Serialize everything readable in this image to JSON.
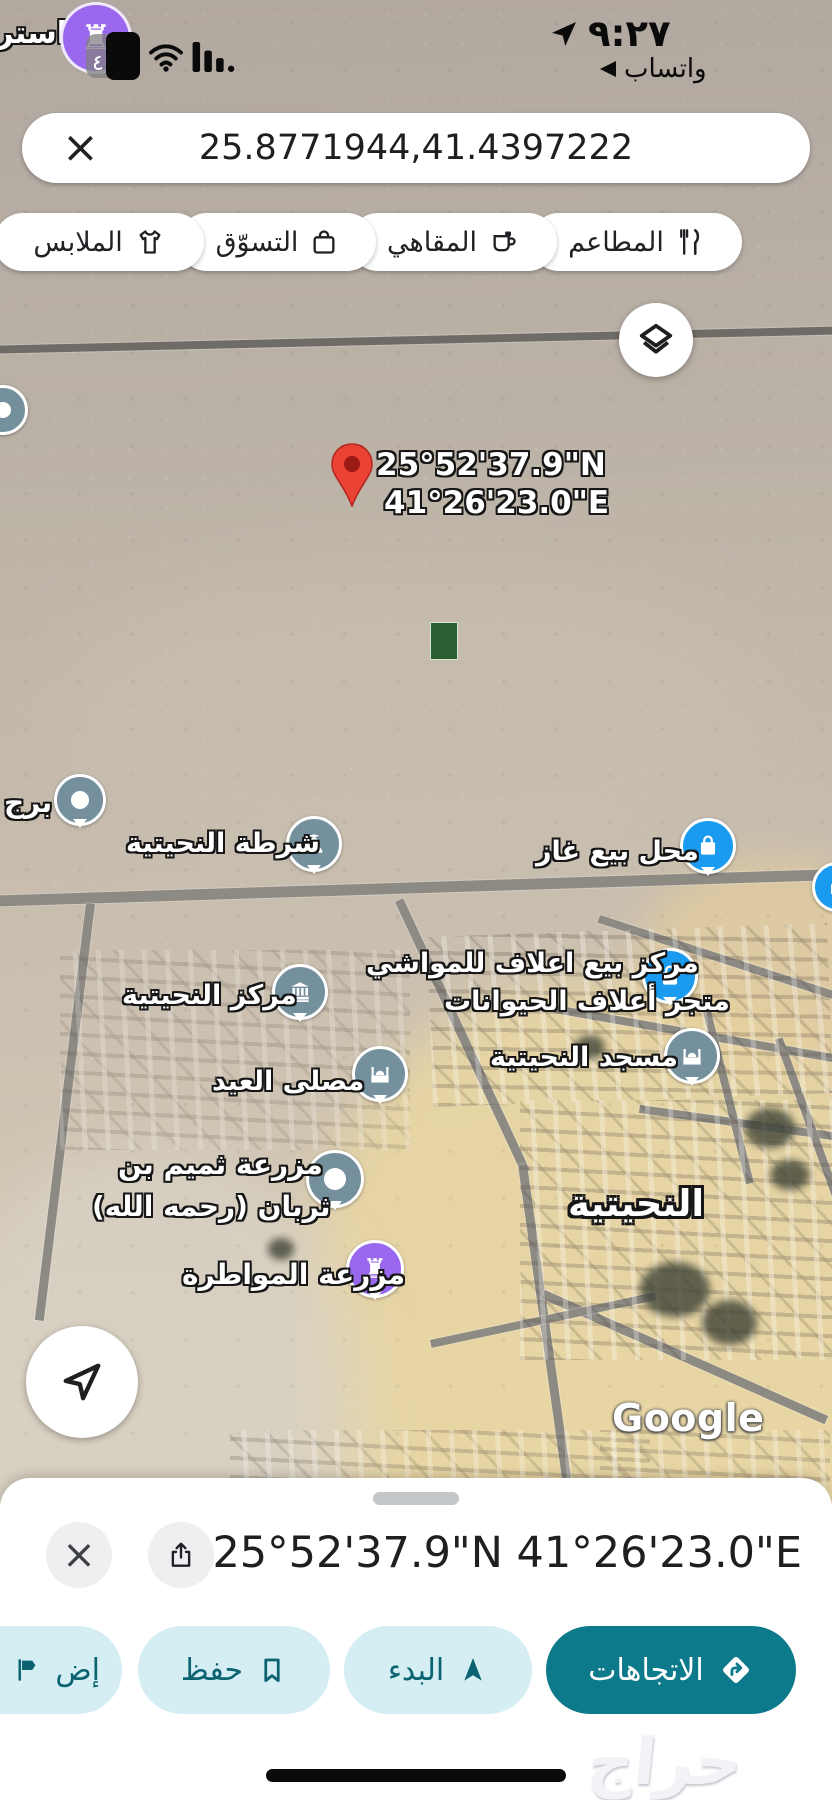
{
  "status_bar": {
    "time": "٩:٢٧",
    "notification_label": "واتساب",
    "battery_badge": "٤"
  },
  "icons": {
    "rook_glyph": "♜",
    "close_glyph": "×"
  },
  "map_top_label_partial": "استرا",
  "search_bar": {
    "query": "25.8771944,41.4397222"
  },
  "chips": [
    {
      "label": "المطاعم",
      "icon": "restaurants-icon"
    },
    {
      "label": "المقاهي",
      "icon": "cafes-icon"
    },
    {
      "label": "التسوّق",
      "icon": "shopping-icon"
    },
    {
      "label": "الملابس",
      "icon": "clothing-icon"
    }
  ],
  "map": {
    "pin_coord_line1": "25°52'37.9\"N",
    "pin_coord_line2": "41°26'23.0\"E",
    "labels": {
      "tower": "برج",
      "police": "شرطة النحيتية",
      "gas_shop": "محل بيع غاز",
      "feed_center_line1": "مركز بيع اعلاف للمواشي",
      "feed_center_line2": "متجر أعلاف الحيوانات",
      "town_center": "مركز النحيتية",
      "eid_musalla": "مصلى العيد",
      "mosque": "مسجد النحيتية",
      "farm_line1": "مزرعة ثميم بن",
      "farm_line2": "ثربان (رحمه الله)",
      "town": "النحيتية",
      "muwatara_farm": "مزرعة المواطرة"
    },
    "google_logo": "Google"
  },
  "bottom_sheet": {
    "coordinates": "25°52'37.9\"N 41°26'23.0\"E",
    "actions": {
      "directions": "الاتجاهات",
      "start": "البدء",
      "save": "حفظ",
      "add_label_partial": "إض"
    }
  },
  "watermark": "حراج",
  "colors": {
    "accent_teal": "#0c7a8a",
    "light_teal": "#d4eef4",
    "marker_slate": "#74909d",
    "marker_blue": "#1a9bf0",
    "marker_purple": "#9a68ee",
    "pin_red": "#ea4335"
  }
}
